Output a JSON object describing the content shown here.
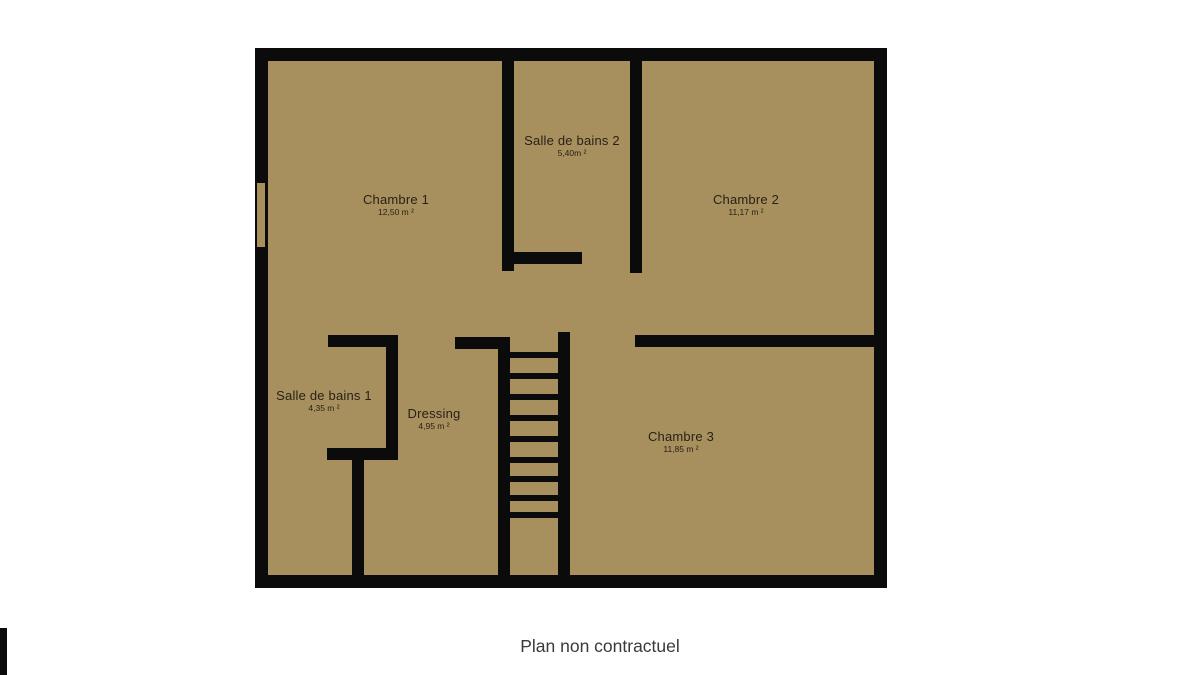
{
  "caption": "Plan non contractuel",
  "colors": {
    "background": "#ffffff",
    "floor": "#a8905e",
    "wall": "#0b0b0b",
    "label": "#282117",
    "caption": "#3a3a3a"
  },
  "rooms": [
    {
      "id": "chambre-1",
      "name": "Chambre 1",
      "area": "12,50 m ²",
      "cx": 396,
      "cy": 205
    },
    {
      "id": "salle-de-bains-2",
      "name": "Salle de bains 2",
      "area": "5,40m ²",
      "cx": 572,
      "cy": 146
    },
    {
      "id": "chambre-2",
      "name": "Chambre 2",
      "area": "11,17 m ²",
      "cx": 746,
      "cy": 205
    },
    {
      "id": "salle-de-bains-1",
      "name": "Salle de bains 1",
      "area": "4,35 m ²",
      "cx": 324,
      "cy": 401
    },
    {
      "id": "dressing",
      "name": "Dressing",
      "area": "4,95 m ²",
      "cx": 434,
      "cy": 419
    },
    {
      "id": "chambre-3",
      "name": "Chambre 3",
      "area": "11,85 m ²",
      "cx": 681,
      "cy": 442
    }
  ],
  "plan": {
    "outer": {
      "x": 255,
      "y": 48,
      "w": 632,
      "h": 540,
      "wall_thickness": 13
    },
    "walls": [
      {
        "id": "sdb2-left-wall",
        "x": 247,
        "y": 13,
        "w": 12,
        "h": 210
      },
      {
        "id": "sdb2-bottom-stub",
        "x": 247,
        "y": 204,
        "w": 80,
        "h": 12
      },
      {
        "id": "sdb2-right-wall",
        "x": 375,
        "y": 13,
        "w": 12,
        "h": 212
      },
      {
        "id": "chambre3-top-wall",
        "x": 380,
        "y": 287,
        "w": 252,
        "h": 12
      },
      {
        "id": "sdb1-top-stub",
        "x": 73,
        "y": 287,
        "w": 70,
        "h": 12
      },
      {
        "id": "sdb1-right-wall",
        "x": 131,
        "y": 287,
        "w": 12,
        "h": 125
      },
      {
        "id": "sdb1-bottom-stub",
        "x": 72,
        "y": 400,
        "w": 71,
        "h": 12
      },
      {
        "id": "corridor-wall",
        "x": 97,
        "y": 412,
        "w": 12,
        "h": 115
      },
      {
        "id": "dressing-top-stub",
        "x": 200,
        "y": 289,
        "w": 55,
        "h": 12
      },
      {
        "id": "stair-left-wall",
        "x": 243,
        "y": 289,
        "w": 12,
        "h": 238
      },
      {
        "id": "stair-right-wall",
        "x": 303,
        "y": 284,
        "w": 12,
        "h": 243
      }
    ],
    "window": {
      "x": 1,
      "y": 134,
      "w": 10,
      "h": 66
    },
    "stairs": {
      "x": 255,
      "w": 48,
      "rung_height": 6,
      "rung_ys": [
        304,
        325,
        346,
        367,
        388,
        409,
        428,
        447,
        464
      ]
    }
  },
  "caption_top": 636,
  "edge_artifact": {
    "x": 0,
    "y": 628,
    "w": 7,
    "h": 47
  }
}
